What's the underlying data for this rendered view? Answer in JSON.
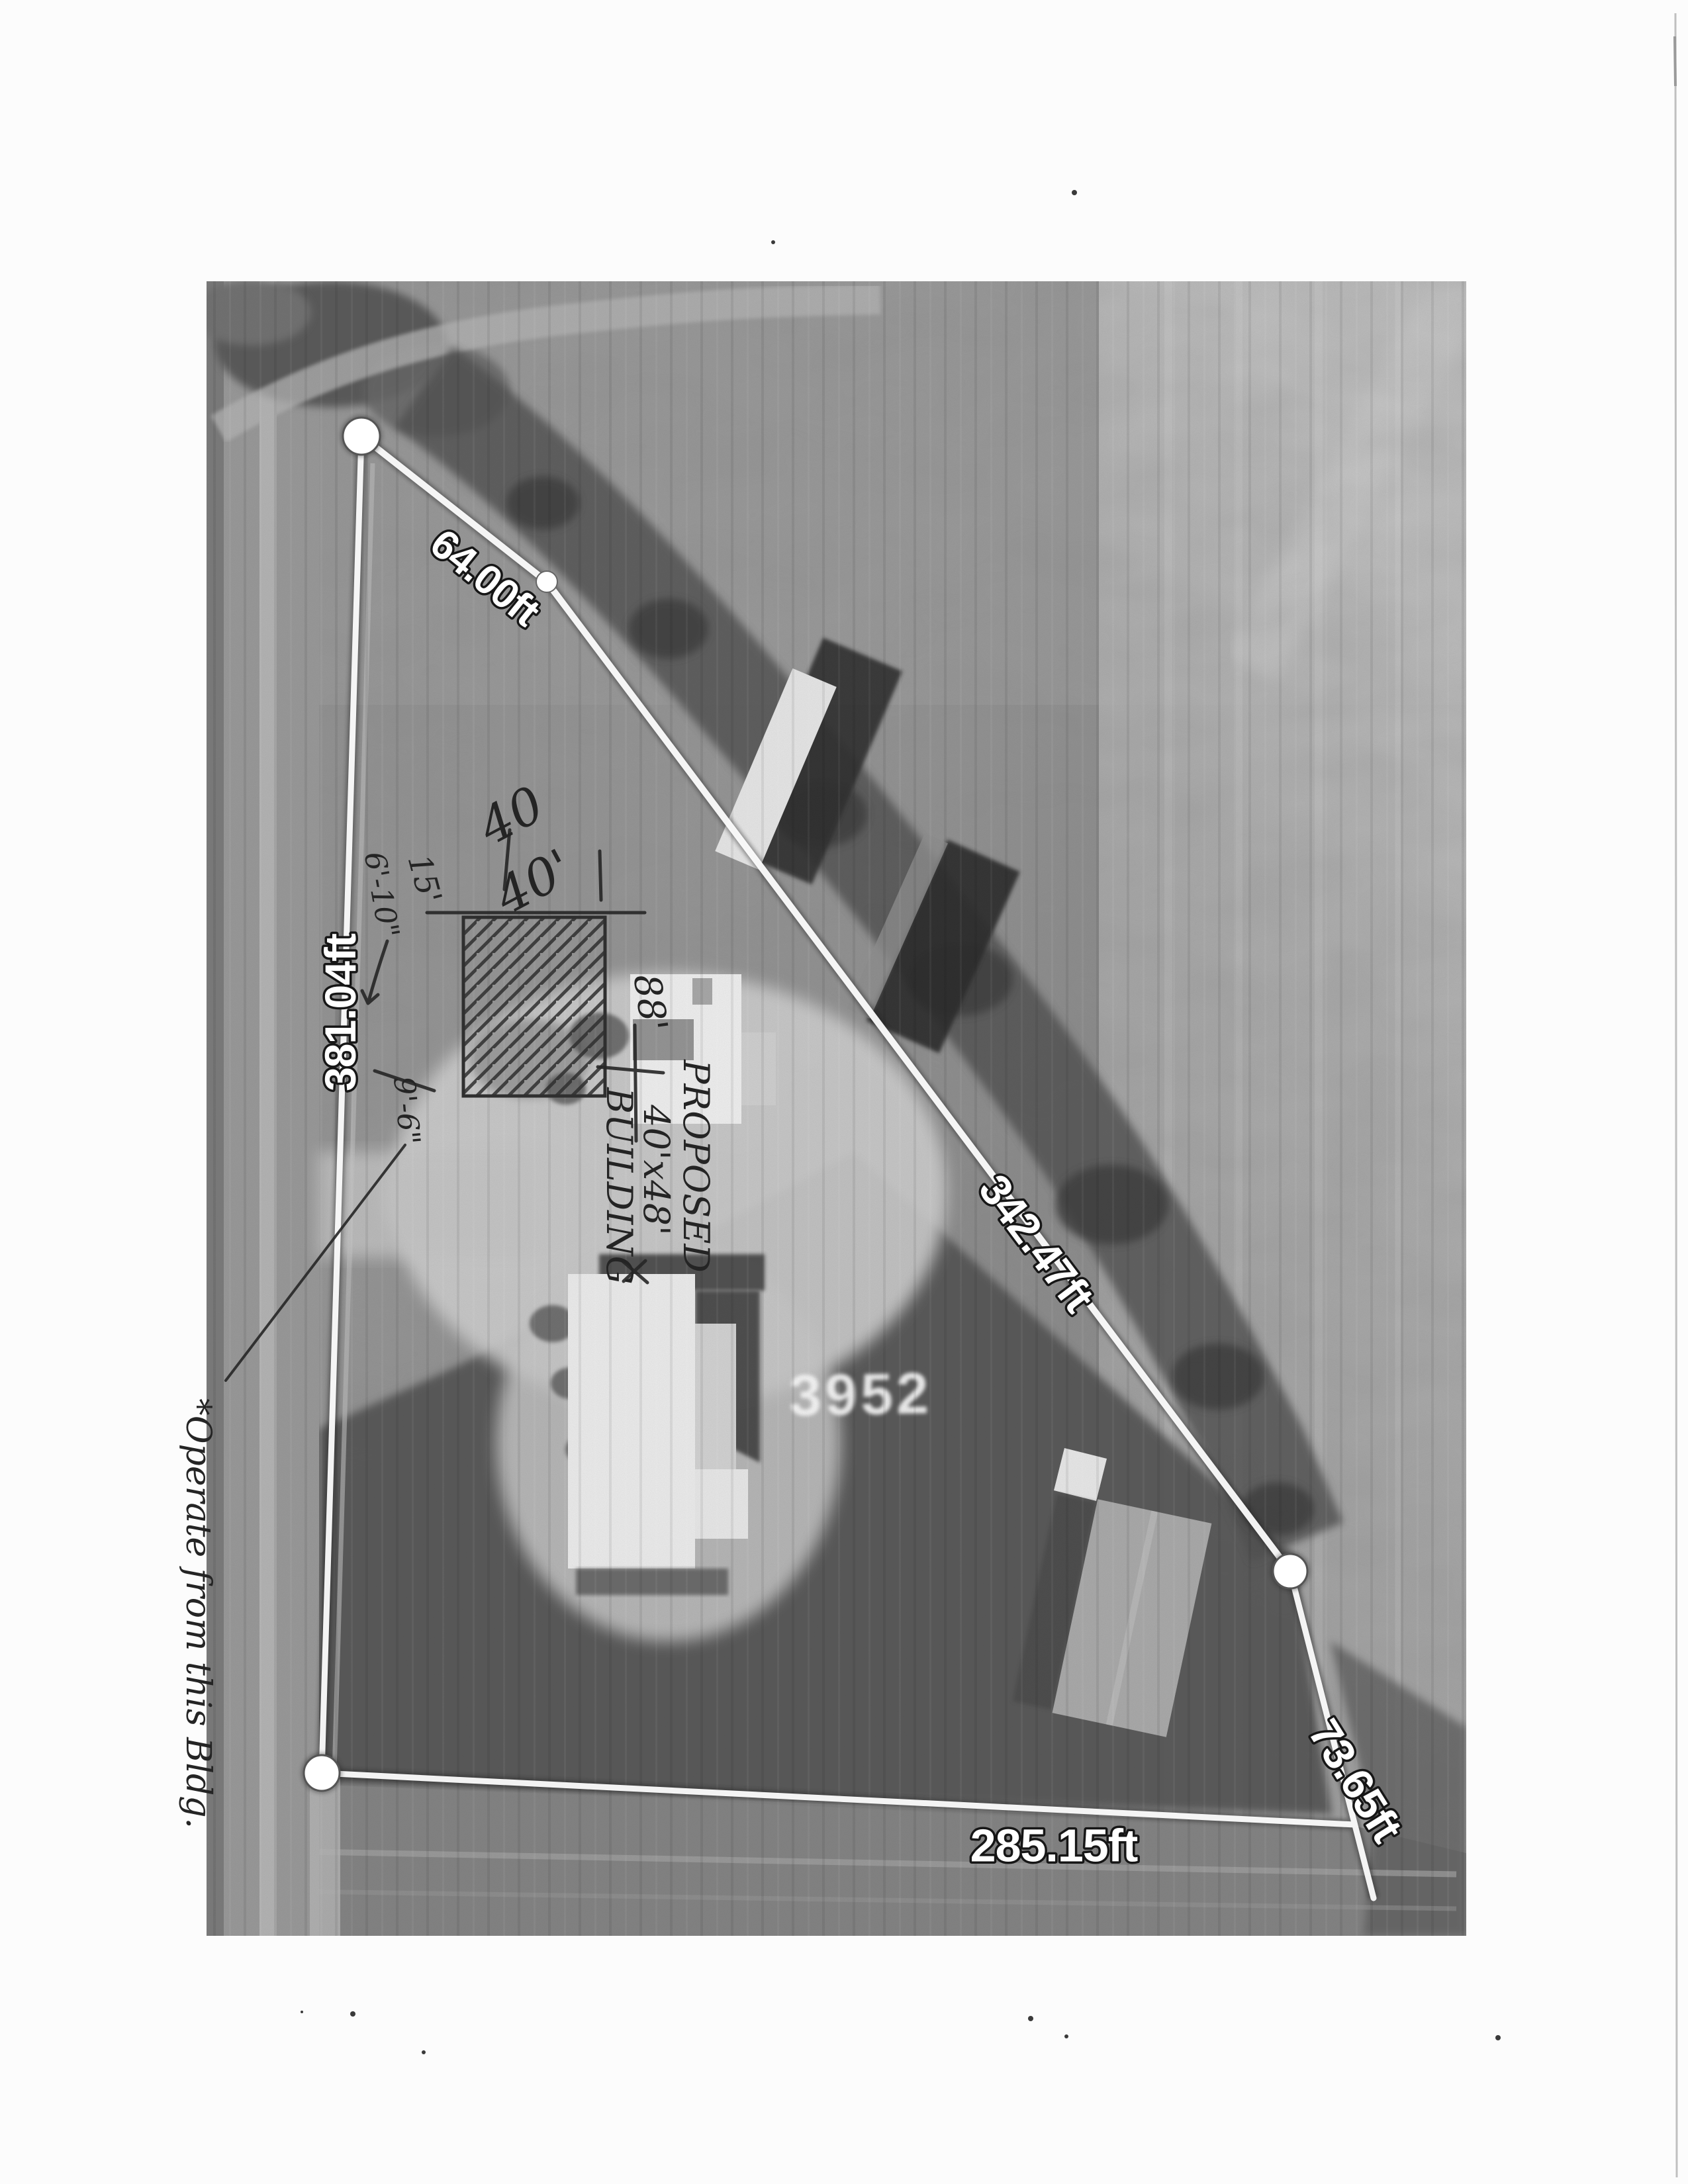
{
  "document": {
    "kind": "scanned aerial site plan with property measurements",
    "orientation": "portrait scan of landscape map"
  },
  "map": {
    "labels": {
      "north": "64.00ft",
      "west": "381.04ft",
      "northeast": "342.47ft",
      "southeast": "73.65ft",
      "south": "285.15ft"
    },
    "ground_house_number": "3952",
    "vertex_count": 4,
    "overlay_line_color": "#ffffff",
    "photo_tone": "#8f8f8f"
  },
  "handwriting": {
    "proposed": [
      "PROPOSED",
      "40'x48'",
      "BUILDING"
    ],
    "dim_a": "40",
    "dim_b": "40'",
    "setback_upper": "6'-10\"",
    "setback_upper_alt": "15'",
    "setback_lower": "9'-6\"",
    "side_dim": "88'",
    "margin_note": "*Operate from this Bldg.",
    "ink_color": "#262626"
  }
}
